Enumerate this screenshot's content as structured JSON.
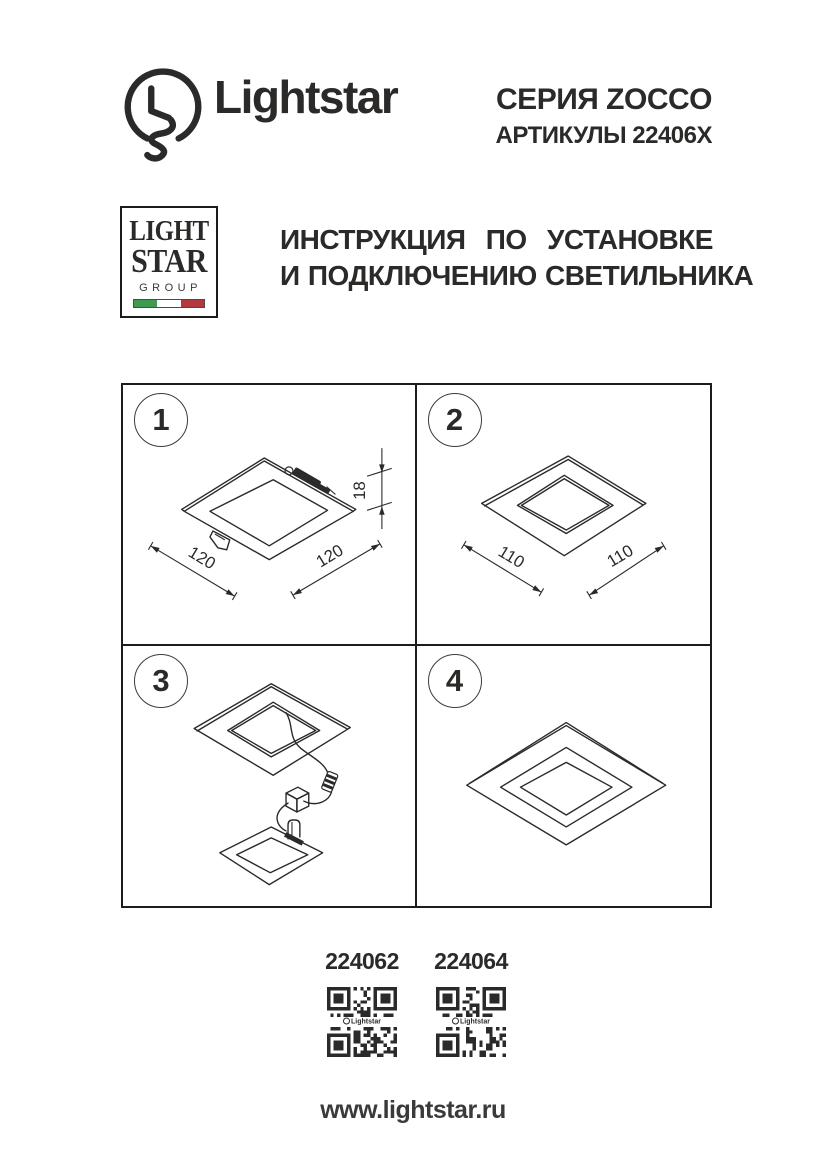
{
  "header": {
    "brand": "Lightstar",
    "series": "СЕРИЯ ZOCCO",
    "articles": "АРТИКУЛЫ 22406X"
  },
  "group_logo": {
    "word1": "LIGHT",
    "word2": "STAR",
    "word3": "GROUP"
  },
  "title": {
    "line1": "ИНСТРУКЦИЯ ПО УСТАНОВКЕ",
    "line2": "И ПОДКЛЮЧЕНИЮ СВЕТИЛЬНИКА"
  },
  "steps": [
    {
      "number": "1",
      "dim_left": "120",
      "dim_right": "120",
      "dim_height": "18"
    },
    {
      "number": "2",
      "dim_left": "110",
      "dim_right": "110"
    },
    {
      "number": "3"
    },
    {
      "number": "4"
    }
  ],
  "footer": {
    "articles": [
      {
        "code": "224062"
      },
      {
        "code": "224064"
      }
    ],
    "qr_label": "Lightstar",
    "website": "www.lightstar.ru"
  },
  "colors": {
    "ink": "#2b2a29",
    "grid_line": "#1c1c1c",
    "flag_green": "#3d9a4e",
    "flag_white": "#ffffff",
    "flag_red": "#b03a3e"
  }
}
